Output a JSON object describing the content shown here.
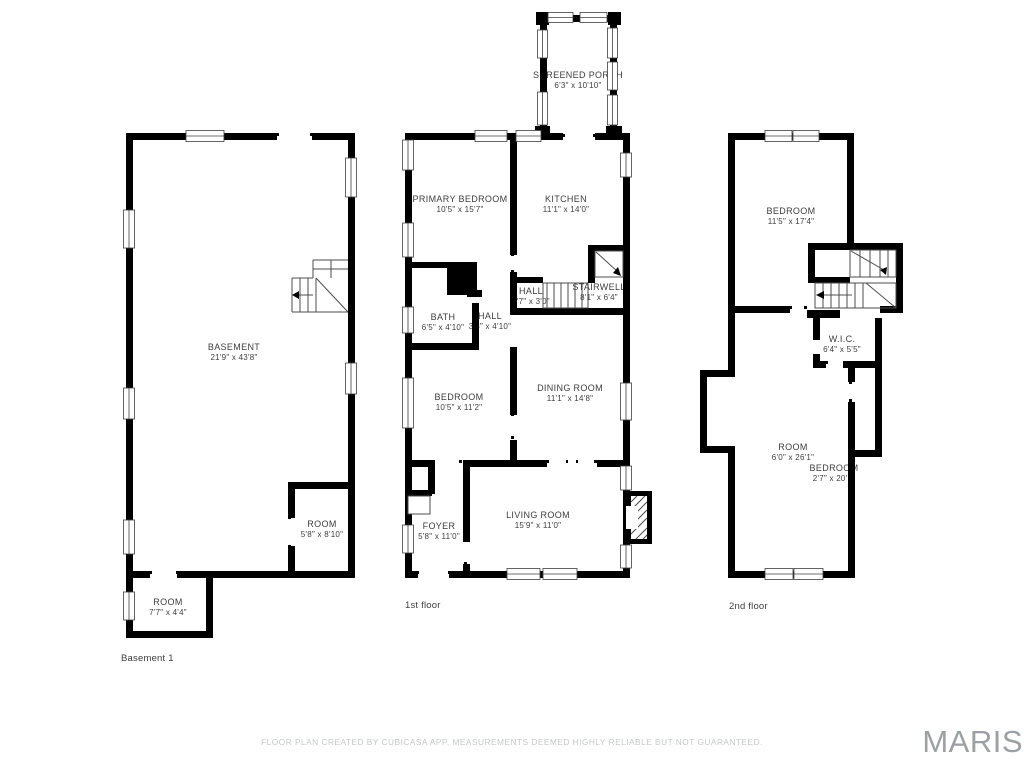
{
  "floors": [
    {
      "name": "Basement 1",
      "rooms": [
        {
          "label": "BASEMENT",
          "dims": "21'9\" x 43'8\""
        },
        {
          "label": "ROOM",
          "dims": "5'8\" x 8'10\""
        },
        {
          "label": "ROOM",
          "dims": "7'7\" x 4'4\""
        }
      ]
    },
    {
      "name": "1st floor",
      "rooms": [
        {
          "label": "SCREENED PORCH",
          "dims": "6'3\" x 10'10\""
        },
        {
          "label": "PRIMARY BEDROOM",
          "dims": "10'5\" x 15'7\""
        },
        {
          "label": "KITCHEN",
          "dims": "11'1\" x 14'0\""
        },
        {
          "label": "HALL",
          "dims": "7'7\" x 3'0\""
        },
        {
          "label": "STAIRWELL",
          "dims": "8'1\" x 6'4\""
        },
        {
          "label": "BATH",
          "dims": "6'5\" x 4'10\""
        },
        {
          "label": "HALL",
          "dims": "3'8\" x 4'10\""
        },
        {
          "label": "BEDROOM",
          "dims": "10'5\" x 11'2\""
        },
        {
          "label": "DINING ROOM",
          "dims": "11'1\" x 14'8\""
        },
        {
          "label": "FOYER",
          "dims": "5'8\" x 11'0\""
        },
        {
          "label": "LIVING ROOM",
          "dims": "15'9\" x 11'0\""
        }
      ]
    },
    {
      "name": "2nd floor",
      "rooms": [
        {
          "label": "BEDROOM",
          "dims": "11'5\" x 17'4\""
        },
        {
          "label": "W.I.C.",
          "dims": "6'4\" x 5'5\""
        },
        {
          "label": "ROOM",
          "dims": "6'0\" x 26'1\""
        },
        {
          "label": "BEDROOM",
          "dims": "2'7\" x 20'1\""
        }
      ]
    }
  ],
  "footer": {
    "disclaimer": "FLOOR PLAN CREATED BY CUBICASA APP. MEASUREMENTS DEEMED HIGHLY RELIABLE BUT NOT GUARANTEED.",
    "logo": "MARIS"
  },
  "colors": {
    "wall": "#000000",
    "thin_line": "#3f3f3f",
    "label_text": "#3d3d3d",
    "disclaimer_text": "#c4c7c9",
    "logo_text": "#9ca0a2"
  }
}
